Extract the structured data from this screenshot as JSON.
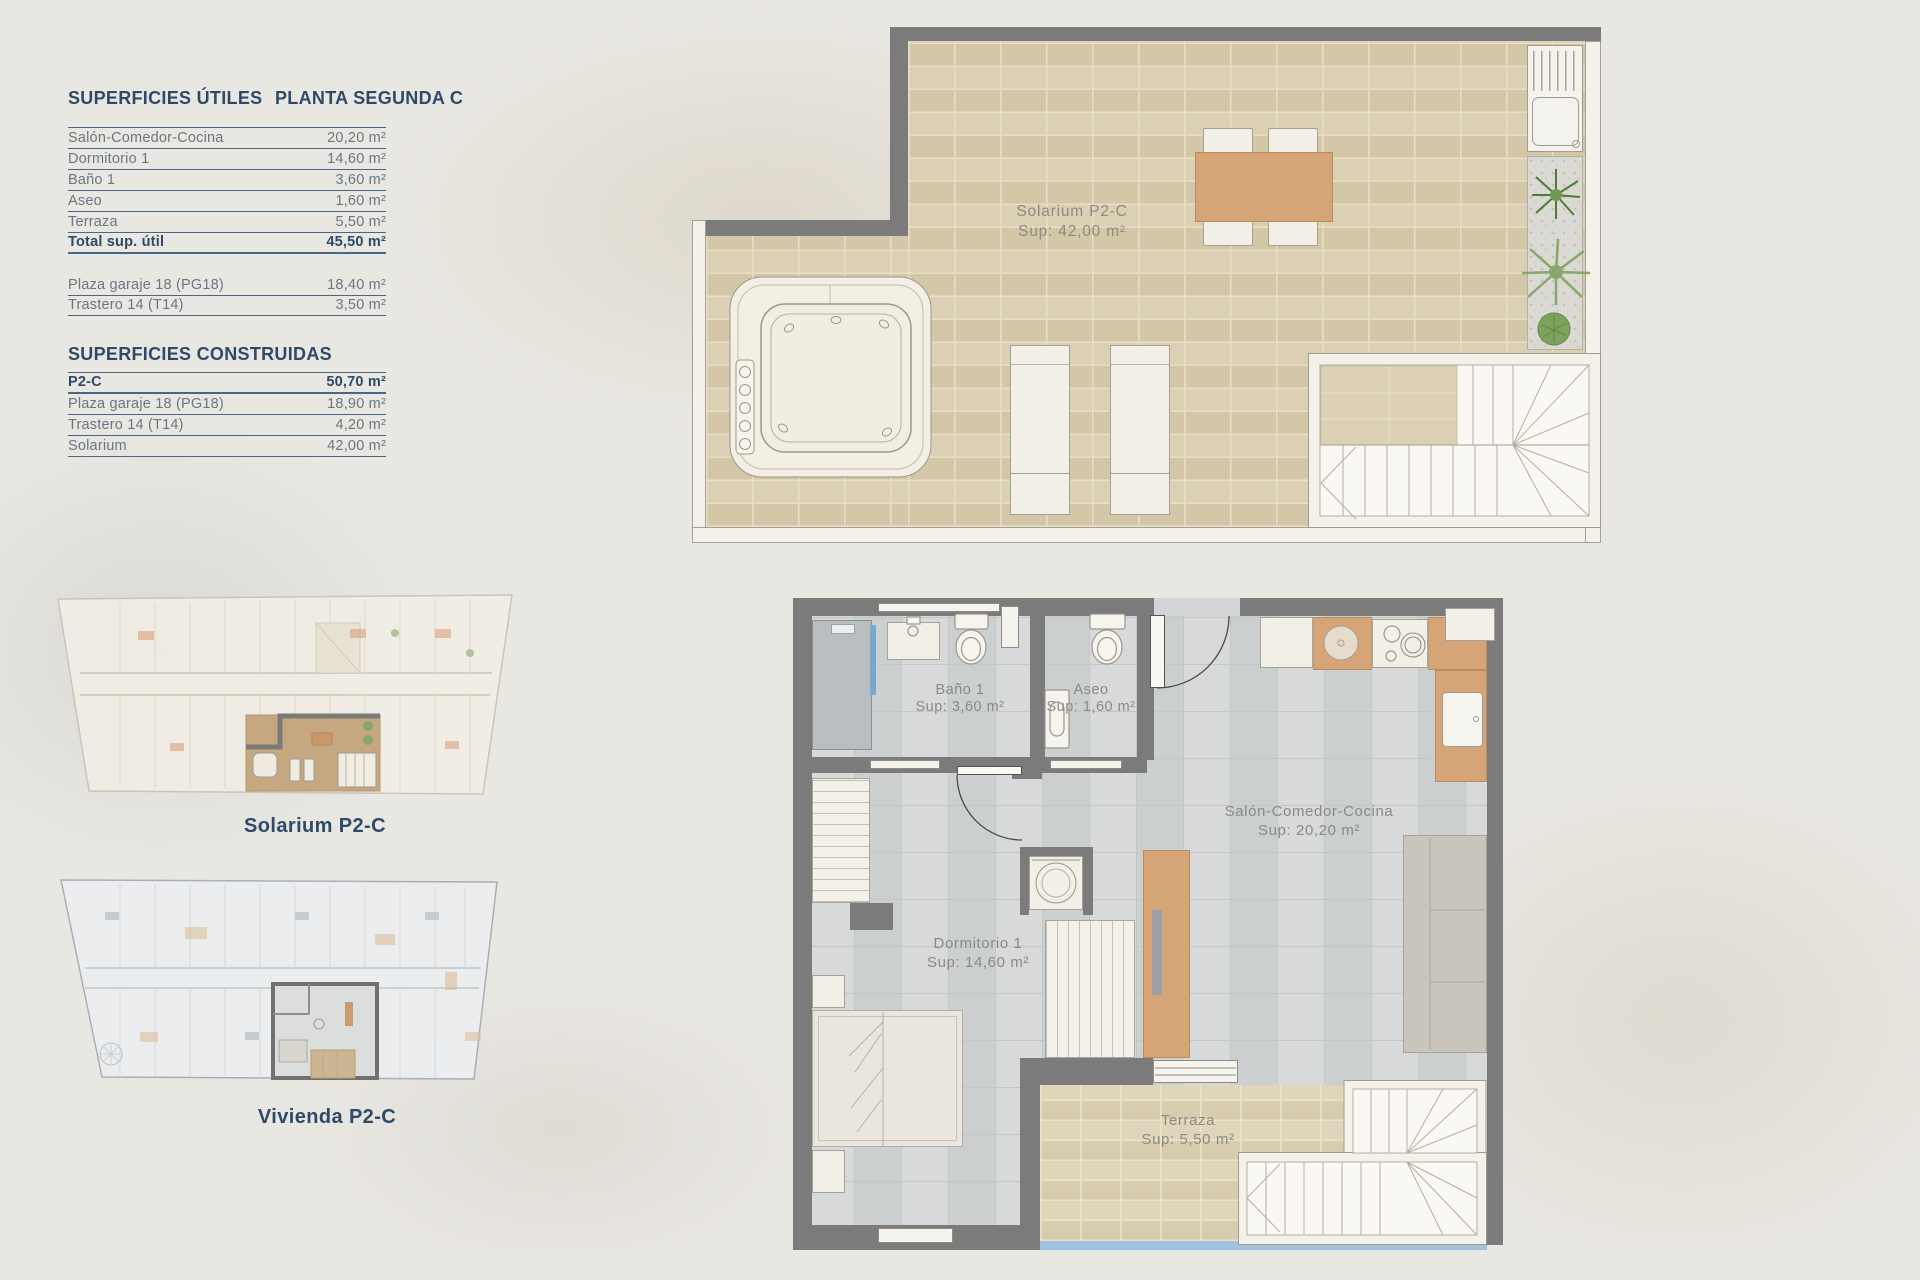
{
  "panel": {
    "title_left": "SUPERFICIES ÚTILES",
    "title_right": "PLANTA SEGUNDA C",
    "utiles_rows": [
      {
        "label": "Salón-Comedor-Cocina",
        "value": "20,20 m²"
      },
      {
        "label": "Dormitorio 1",
        "value": "14,60 m²"
      },
      {
        "label": "Baño 1",
        "value": "3,60 m²"
      },
      {
        "label": "Aseo",
        "value": "1,60 m²"
      },
      {
        "label": "Terraza",
        "value": "5,50 m²"
      }
    ],
    "total_row": {
      "label": "Total sup. útil",
      "value": "45,50 m²"
    },
    "annex_rows": [
      {
        "label": "Plaza garaje 18 (PG18)",
        "value": "18,40 m²"
      },
      {
        "label": "Trastero 14 (T14)",
        "value": "3,50 m²"
      }
    ],
    "construidas_title": "SUPERFICIES CONSTRUIDAS",
    "construidas_rows": [
      {
        "label": "P2-C",
        "value": "50,70 m²"
      },
      {
        "label": "Plaza garaje 18 (PG18)",
        "value": "18,90 m²"
      },
      {
        "label": "Trastero 14 (T14)",
        "value": "4,20 m²"
      },
      {
        "label": "Solarium",
        "value": "42,00 m²"
      }
    ]
  },
  "overview": {
    "solarium_caption": "Solarium P2-C",
    "vivienda_caption": "Vivienda P2-C"
  },
  "solarium_plan": {
    "name": "Solarium P2-C",
    "area": "Sup: 42,00 m²"
  },
  "vivienda_plan": {
    "bano": {
      "name": "Baño 1",
      "area": "Sup: 3,60 m²"
    },
    "aseo": {
      "name": "Aseo",
      "area": "Sup: 1,60 m²"
    },
    "salon": {
      "name": "Salón-Comedor-Cocina",
      "area": "Sup: 20,20 m²"
    },
    "dormitorio": {
      "name": "Dormitorio 1",
      "area": "Sup: 14,60 m²"
    },
    "terraza": {
      "name": "Terraza",
      "area": "Sup: 5,50 m²"
    }
  },
  "colors": {
    "navy": "#2e4a68",
    "row-text": "#6b7683",
    "rule": "#4a6687",
    "wall-dark": "#7b7b7b",
    "wall-light": "#f3f1ea",
    "tile-beige": "#d8ccae",
    "tile-grout": "#e8dfc6",
    "floor-gray": "#d3d5d6",
    "floor-grout": "#c4c7c8",
    "wood": "#d5a578",
    "label-gray": "#8b8a82",
    "sofa-gray": "#c9c5bd",
    "water-blue": "#9fc3dd",
    "shower-gray": "#b9bec3",
    "glass-blue": "#7ba7c9",
    "highlight-tan": "#c2a277"
  }
}
